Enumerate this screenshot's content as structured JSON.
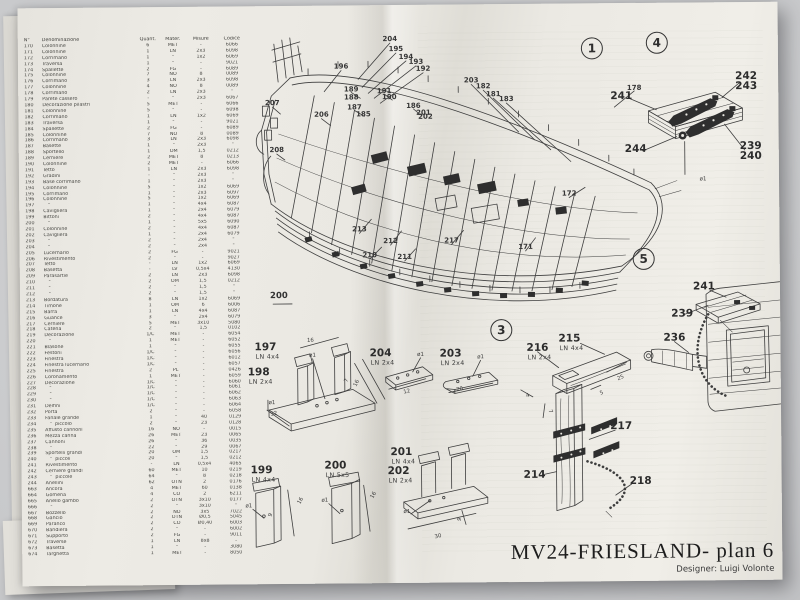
{
  "title_block": {
    "title": "MV24-FRIESLAND- plan 6",
    "designer": "Designer: Luigi Volonte"
  },
  "sections": [
    "1",
    "3",
    "4",
    "5"
  ],
  "misc": {
    "group_label": "200"
  },
  "colors": {
    "paper": "#eae8e2",
    "ink": "#3e3e3e",
    "backdrop": "#c7c8ca"
  },
  "parts_table": {
    "headers": [
      "N°",
      "Denominazione",
      "Quant.",
      "Mater.",
      "Misure",
      "Codice"
    ],
    "rows": [
      [
        "170",
        "Colonnine",
        "6",
        "MET",
        "-",
        "6066"
      ],
      [
        "171",
        "Colonnine",
        "1",
        "LN",
        "2x3",
        "6098"
      ],
      [
        "172",
        "Corrimano",
        "1",
        "\"",
        "1x2",
        "6069"
      ],
      [
        "173",
        "Traversa",
        "1",
        "\"",
        "-",
        "9021"
      ],
      [
        "174",
        "Spallette",
        "2",
        "FG",
        "-",
        "6089"
      ],
      [
        "175",
        "Colonnine",
        "7",
        "NO",
        "8",
        "0089"
      ],
      [
        "176",
        "Corrimano",
        "3",
        "LN",
        "2x3",
        "6098"
      ],
      [
        "177",
        "Colonnine",
        "4",
        "NO",
        "8",
        "0089"
      ],
      [
        "178",
        "Corrimano",
        "2",
        "LN",
        "2x3",
        "\""
      ],
      [
        "179",
        "Parete cassero",
        "-",
        "\"",
        "2x3",
        "6067"
      ],
      [
        "180",
        "Decorazione pilastri",
        "5",
        "MET",
        "-",
        "6066"
      ],
      [
        "181",
        "Colonnine",
        "5",
        "\"",
        "-",
        "6098"
      ],
      [
        "182",
        "Corrimano",
        "1",
        "LN",
        "1x2",
        "6069"
      ],
      [
        "183",
        "Traversa",
        "1",
        "\"",
        "-",
        "9021"
      ],
      [
        "184",
        "Spallette",
        "2",
        "FG",
        "-",
        "6089"
      ],
      [
        "185",
        "Colonnine",
        "7",
        "NO",
        "8",
        "0089"
      ],
      [
        "186",
        "Corrimano",
        "3",
        "LN",
        "2x3",
        "6098"
      ],
      [
        "187",
        "Basette",
        "1",
        "\"",
        "2x3",
        "\""
      ],
      [
        "188",
        "Sportello",
        "1",
        "OM",
        "1,5",
        "0212"
      ],
      [
        "189",
        "Cerniere",
        "2",
        "MET",
        "8",
        "0213"
      ],
      [
        "190",
        "Colonnine",
        "2",
        "MET",
        "-",
        "6066"
      ],
      [
        "191",
        "Tetto",
        "1",
        "LN",
        "2x3",
        "6098"
      ],
      [
        "192",
        "Gradini",
        "-",
        "\"",
        "2x3",
        "\""
      ],
      [
        "193",
        "Base corrimano",
        "1",
        "\"",
        "2x3",
        "\""
      ],
      [
        "194",
        "Colonnine",
        "5",
        "\"",
        "1x2",
        "6069"
      ],
      [
        "195",
        "Corrimano",
        "1",
        "\"",
        "2x3",
        "6097"
      ],
      [
        "196",
        "Colonnine",
        "5",
        "\"",
        "1x2",
        "6069"
      ],
      [
        "197",
        "   \"",
        "1",
        "\"",
        "4x4",
        "6087"
      ],
      [
        "198",
        "Cavigliera",
        "1",
        "\"",
        "2x4",
        "6079"
      ],
      [
        "199",
        "Bittoni",
        "2",
        "\"",
        "4x4",
        "6087"
      ],
      [
        "200",
        "   \"",
        "1",
        "\"",
        "5x5",
        "6090"
      ],
      [
        "201",
        "Colonnine",
        "2",
        "\"",
        "4x4",
        "6087"
      ],
      [
        "202",
        "Cavigliera",
        "1",
        "\"",
        "2x4",
        "6079"
      ],
      [
        "203",
        "   \"",
        "2",
        "\"",
        "2x4",
        "\""
      ],
      [
        "204",
        "   \"",
        "2",
        "\"",
        "2x4",
        "\""
      ],
      [
        "205",
        "Lucernario",
        "2",
        "FG",
        "-",
        "9021"
      ],
      [
        "206",
        "Rivestimento",
        "2",
        "\"",
        "-",
        "9027"
      ],
      [
        "207",
        "Tetto",
        "-",
        "LN",
        "1x2",
        "6069"
      ],
      [
        "208",
        "Basetta",
        "-",
        "LV",
        "0,5x4",
        "4130"
      ],
      [
        "209",
        "Parasartie",
        "2",
        "LN",
        "2x3",
        "6098"
      ],
      [
        "210",
        "   \"",
        "2",
        "OM",
        "1,5",
        "0212"
      ],
      [
        "211",
        "   \"",
        "2",
        "\"",
        "1,5",
        "\""
      ],
      [
        "212",
        "   \"",
        "2",
        "\"",
        "1,5",
        "\""
      ],
      [
        "213",
        "Bordatura",
        "8",
        "LN",
        "1x2",
        "6069"
      ],
      [
        "214",
        "Timone",
        "1",
        "OM",
        "6",
        "6006"
      ],
      [
        "215",
        "Barra",
        "1",
        "LN",
        "4x4",
        "6087"
      ],
      [
        "216",
        "Guance",
        "3",
        "\"",
        "2x4",
        "6079"
      ],
      [
        "217",
        "Cerniere",
        "5",
        "MET",
        "3x10",
        "5080"
      ],
      [
        "218",
        "Catena",
        "2",
        "\"",
        "1,5",
        "0102"
      ],
      [
        "219",
        "Decorazione",
        "1/C",
        "MET",
        "-",
        "6054"
      ],
      [
        "220",
        "   \"",
        "1",
        "MET",
        "-",
        "6052"
      ],
      [
        "221",
        "Blasone",
        "1",
        "\"",
        "-",
        "6055"
      ],
      [
        "222",
        "Festoni",
        "1/C",
        "\"",
        "-",
        "6056"
      ],
      [
        "223",
        "Finestra",
        "1/C",
        "\"",
        "-",
        "6012"
      ],
      [
        "224",
        "Finestra lucernario",
        "1/C",
        "\"",
        "-",
        "6057"
      ],
      [
        "225",
        "Finestra",
        "2",
        "PL",
        "-",
        "0426"
      ],
      [
        "226",
        "Coronamento",
        "1",
        "MET",
        "-",
        "6059"
      ],
      [
        "227",
        "Decorazione",
        "1/C",
        "\"",
        "-",
        "6060"
      ],
      [
        "228",
        "   \"",
        "1/C",
        "\"",
        "-",
        "6061"
      ],
      [
        "229",
        "   \"",
        "1/C",
        "\"",
        "-",
        "6062"
      ],
      [
        "230",
        "   \"",
        "1/C",
        "\"",
        "-",
        "6063"
      ],
      [
        "231",
        "Delfini",
        "1/C",
        "\"",
        "-",
        "6064"
      ],
      [
        "232",
        "Porta",
        "2",
        "\"",
        "-",
        "6058"
      ],
      [
        "233",
        "Fanale grande",
        "1",
        "\"",
        "40",
        "0129"
      ],
      [
        "234",
        "   \"  piccolo",
        "2",
        "\"",
        "23",
        "0128"
      ],
      [
        "235",
        "Affusto cannoni",
        "16",
        "NO",
        "-",
        "0015"
      ],
      [
        "236",
        "Mezza canna",
        "26",
        "MET",
        "23",
        "0065"
      ],
      [
        "237",
        "Cannoni",
        "26",
        "\"",
        "36",
        "0035"
      ],
      [
        "238",
        "   \"",
        "22",
        "\"",
        "29",
        "0067"
      ],
      [
        "239",
        "Sportelli grandi",
        "20",
        "OM",
        "1,5",
        "0217"
      ],
      [
        "240",
        "   \"  piccoli",
        "20",
        "\"",
        "1,5",
        "0212"
      ],
      [
        "241",
        "Rivestimento",
        "-",
        "LN",
        "0,5x4",
        "4065"
      ],
      [
        "242",
        "Cerniere grandi",
        "60",
        "MET",
        "10",
        "0219"
      ],
      [
        "243",
        "   \"  piccole",
        "64",
        "\"",
        "8",
        "0218"
      ],
      [
        "244",
        "Anellini",
        "62",
        "OTN",
        "2",
        "0176"
      ],
      [
        "663",
        "Ancora",
        "4",
        "MET",
        "60",
        "0138"
      ],
      [
        "664",
        "Gomena",
        "4",
        "CO",
        "2",
        "6211"
      ],
      [
        "665",
        "Anello gambo",
        "2",
        "OTN",
        "3x10",
        "0177"
      ],
      [
        "666",
        "   \"",
        "2",
        "\"",
        "3x10",
        "\""
      ],
      [
        "667",
        "Bozzello",
        "2",
        "NO",
        "3x5",
        "7022"
      ],
      [
        "668",
        "Gancio",
        "2",
        "OTN",
        "Ø0,5",
        "5045"
      ],
      [
        "669",
        "Paranco",
        "2",
        "CO",
        "Ø0,40",
        "6003"
      ],
      [
        "670",
        "Bandiera",
        "2",
        "\"",
        "-",
        "6002"
      ],
      [
        "671",
        "Supporto",
        "2",
        "FG",
        "-",
        "9011"
      ],
      [
        "672",
        "Traverse",
        "1",
        "LN",
        "8x8",
        "-"
      ],
      [
        "673",
        "Basetta",
        "1",
        "\"",
        "-",
        "3080"
      ],
      [
        "674",
        "Targhetta",
        "1",
        "MET",
        "-",
        "8050"
      ]
    ]
  },
  "ship": {
    "callouts": [
      {
        "t": "204",
        "x": 372,
        "y": 34
      },
      {
        "t": "195",
        "x": 378,
        "y": 44
      },
      {
        "t": "194",
        "x": 388,
        "y": 52
      },
      {
        "t": "193",
        "x": 398,
        "y": 57
      },
      {
        "t": "192",
        "x": 405,
        "y": 64
      },
      {
        "t": "196",
        "x": 323,
        "y": 61
      },
      {
        "t": "189",
        "x": 333,
        "y": 84
      },
      {
        "t": "188",
        "x": 333,
        "y": 92
      },
      {
        "t": "187",
        "x": 336,
        "y": 102
      },
      {
        "t": "185",
        "x": 345,
        "y": 109
      },
      {
        "t": "191",
        "x": 366,
        "y": 86
      },
      {
        "t": "190",
        "x": 371,
        "y": 92
      },
      {
        "t": "186",
        "x": 395,
        "y": 101
      },
      {
        "t": "201",
        "x": 405,
        "y": 108
      },
      {
        "t": "202",
        "x": 407,
        "y": 112
      },
      {
        "t": "203",
        "x": 453,
        "y": 76
      },
      {
        "t": "182",
        "x": 465,
        "y": 82
      },
      {
        "t": "181",
        "x": 475,
        "y": 90
      },
      {
        "t": "183",
        "x": 488,
        "y": 95
      },
      {
        "t": "178",
        "x": 616,
        "y": 85
      },
      {
        "t": "172",
        "x": 550,
        "y": 190
      },
      {
        "t": "213",
        "x": 340,
        "y": 224
      },
      {
        "t": "212",
        "x": 371,
        "y": 236
      },
      {
        "t": "210",
        "x": 350,
        "y": 250
      },
      {
        "t": "211",
        "x": 385,
        "y": 252
      },
      {
        "t": "217",
        "x": 432,
        "y": 236
      },
      {
        "t": "171",
        "x": 506,
        "y": 243
      },
      {
        "t": "207",
        "x": 254,
        "y": 97
      },
      {
        "t": "208",
        "x": 258,
        "y": 144
      },
      {
        "t": "206",
        "x": 303,
        "y": 109
      }
    ]
  },
  "details": [
    {
      "t": "197",
      "spec": "LN 4x4",
      "x": 245,
      "y": 341
    },
    {
      "t": "198",
      "spec": "LN 2x4",
      "x": 238,
      "y": 366
    },
    {
      "t": "204",
      "spec": "LN 2x4",
      "x": 360,
      "y": 348
    },
    {
      "t": "203",
      "spec": "LN 2x4",
      "x": 430,
      "y": 349
    },
    {
      "t": "216",
      "spec": "LN 2x4",
      "x": 517,
      "y": 344
    },
    {
      "t": "215",
      "spec": "LN 4x4",
      "x": 549,
      "y": 335
    },
    {
      "t": "217",
      "x": 600,
      "y": 423
    },
    {
      "t": "214",
      "x": 513,
      "y": 471
    },
    {
      "t": "218",
      "x": 619,
      "y": 478
    },
    {
      "t": "199",
      "spec": "LN 4x4",
      "x": 240,
      "y": 464
    },
    {
      "t": "200",
      "spec": "LN 5x5",
      "x": 314,
      "y": 460
    },
    {
      "t": "201",
      "spec": "LN 4x4",
      "x": 380,
      "y": 447
    },
    {
      "t": "202",
      "spec": "LN 2x4",
      "x": 377,
      "y": 466
    },
    {
      "t": "241",
      "x": 603,
      "y": 93
    },
    {
      "t": "242",
      "x": 728,
      "y": 74
    },
    {
      "t": "243",
      "x": 728,
      "y": 84
    },
    {
      "t": "244",
      "x": 617,
      "y": 146
    },
    {
      "t": "239",
      "x": 732,
      "y": 144
    },
    {
      "t": "240",
      "x": 732,
      "y": 154
    },
    {
      "t": "241",
      "x": 684,
      "y": 284
    },
    {
      "t": "239",
      "x": 662,
      "y": 311
    },
    {
      "t": "236",
      "x": 654,
      "y": 335
    }
  ],
  "dims": [
    {
      "t": "16",
      "x": 290,
      "y": 335
    },
    {
      "t": "ø1",
      "x": 292,
      "y": 350
    },
    {
      "t": "7",
      "x": 326,
      "y": 375,
      "r": -65
    },
    {
      "t": "16",
      "x": 336,
      "y": 378,
      "r": -65
    },
    {
      "t": "ø1",
      "x": 251,
      "y": 397
    },
    {
      "t": "32",
      "x": 253,
      "y": 408,
      "r": -12
    },
    {
      "t": "ø1",
      "x": 400,
      "y": 350
    },
    {
      "t": "12",
      "x": 386,
      "y": 387,
      "r": -12
    },
    {
      "t": "ø1",
      "x": 460,
      "y": 353
    },
    {
      "t": "20",
      "x": 439,
      "y": 385,
      "r": -12
    },
    {
      "t": "25",
      "x": 600,
      "y": 375,
      "r": -22
    },
    {
      "t": "5",
      "x": 581,
      "y": 390,
      "r": -22
    },
    {
      "t": "4",
      "x": 507,
      "y": 392,
      "r": -22
    },
    {
      "t": "7",
      "x": 529,
      "y": 408,
      "r": 65
    },
    {
      "t": "ø1",
      "x": 227,
      "y": 500
    },
    {
      "t": "9",
      "x": 249,
      "y": 509,
      "r": -75
    },
    {
      "t": "16",
      "x": 279,
      "y": 495,
      "r": -60
    },
    {
      "t": "ø1",
      "x": 303,
      "y": 495
    },
    {
      "t": "16",
      "x": 352,
      "y": 490,
      "r": -60
    },
    {
      "t": "30",
      "x": 416,
      "y": 532,
      "r": -12
    },
    {
      "t": "9",
      "x": 438,
      "y": 515,
      "r": -70
    },
    {
      "t": "ø1",
      "x": 385,
      "y": 507
    },
    {
      "t": "ø1",
      "x": 684,
      "y": 177
    }
  ]
}
